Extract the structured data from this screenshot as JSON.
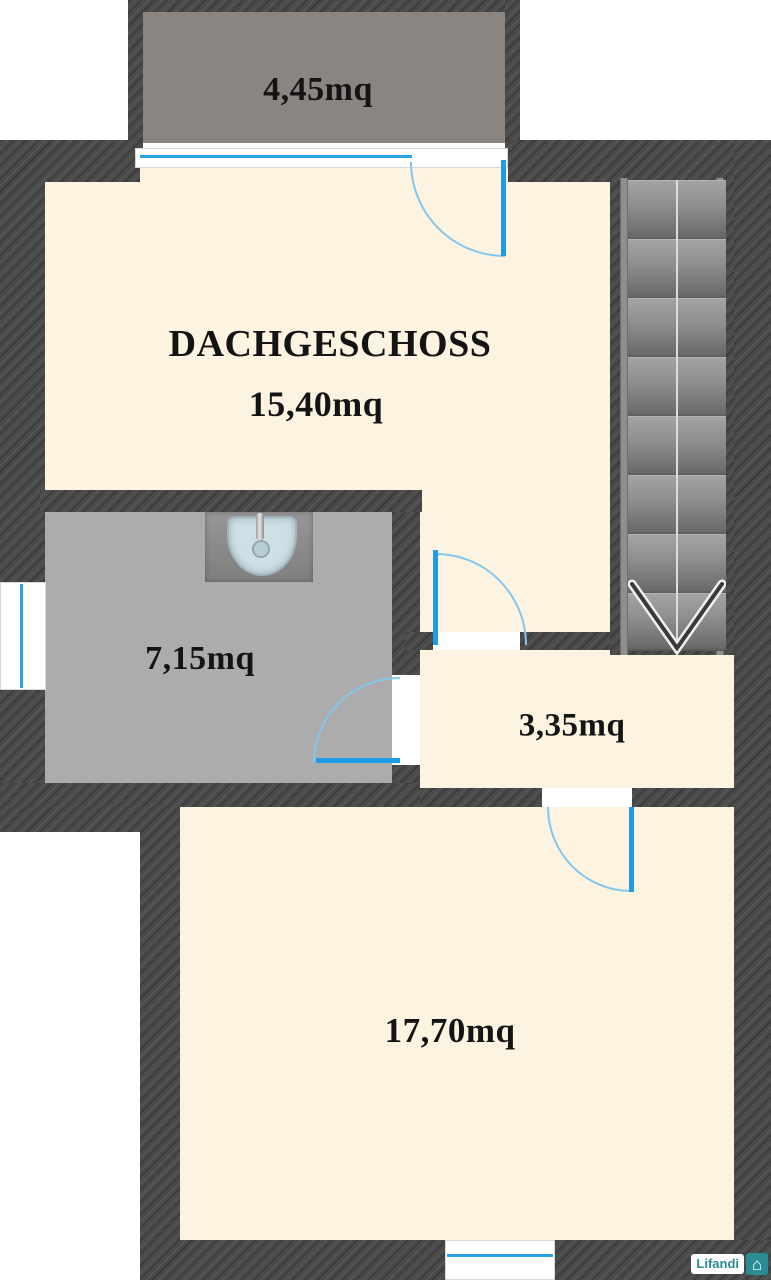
{
  "title": "DACHGESCHOSS",
  "rooms": {
    "balcony": {
      "area": "4,45mq"
    },
    "main": {
      "name": "DACHGESCHOSS",
      "area": "15,40mq"
    },
    "bathroom": {
      "area": "7,15mq"
    },
    "hallway": {
      "area": "3,35mq"
    },
    "bedroom": {
      "area": "17,70mq"
    }
  },
  "stairs": {
    "direction": "down",
    "steps": 8
  },
  "logo": {
    "brand": "Lifandi",
    "icon": "house-icon",
    "glyph": "⌂"
  },
  "colors": {
    "wall": "#4a4a4a",
    "room_floor": "#fcf4e0",
    "balcony_floor": "#8b8582",
    "bathroom_floor": "#acacac",
    "door": "#1f9ce8",
    "door_arc": "#85c6ee",
    "logo_teal": "#2a8c94"
  }
}
